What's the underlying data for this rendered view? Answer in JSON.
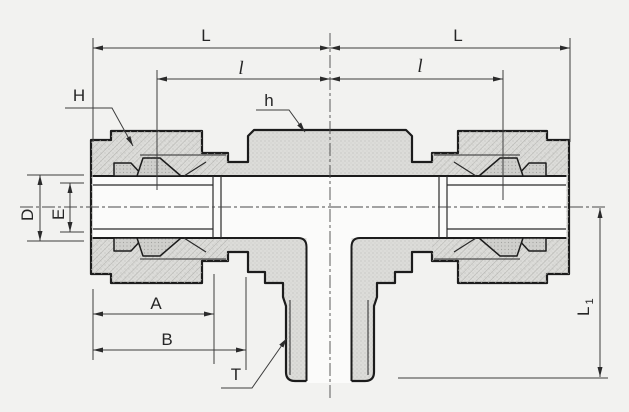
{
  "drawing": {
    "type": "technical-cross-section",
    "subject": "male-branch-tee-tube-fitting",
    "colors": {
      "background": "#f2f2f0",
      "outline": "#1c1c1c",
      "dimension_line": "#3d3d3d",
      "metal_fill": "#dcdcd9",
      "metal_fill_dark": "#cfcfcc",
      "bore_fill": "#fbfbfa"
    },
    "labels": {
      "length_left": "L",
      "length_right": "L",
      "insertion_left": "l",
      "insertion_right": "l",
      "nut_hex": "H",
      "body_hex": "h",
      "tube_od": "D",
      "bore_id": "E",
      "dim_a": "A",
      "dim_b": "B",
      "thread": "T",
      "branch_length_main": "L",
      "branch_length_sub": "1"
    },
    "dimensions": [
      {
        "label": "L",
        "orientation": "horizontal",
        "side": "left-end-to-center"
      },
      {
        "label": "L",
        "orientation": "horizontal",
        "side": "center-to-right-end"
      },
      {
        "label": "l",
        "orientation": "horizontal",
        "side": "left-insert-to-center"
      },
      {
        "label": "l",
        "orientation": "horizontal",
        "side": "center-to-right-insert"
      },
      {
        "label": "H",
        "orientation": "leader",
        "target": "left-nut-hex"
      },
      {
        "label": "h",
        "orientation": "leader",
        "target": "body-hex"
      },
      {
        "label": "D",
        "orientation": "vertical",
        "target": "tube-outer-diameter"
      },
      {
        "label": "E",
        "orientation": "vertical",
        "target": "bore-diameter"
      },
      {
        "label": "A",
        "orientation": "horizontal",
        "target": "nut-length"
      },
      {
        "label": "B",
        "orientation": "horizontal",
        "target": "end-to-body-hex"
      },
      {
        "label": "T",
        "orientation": "leader",
        "target": "male-taper-thread"
      },
      {
        "label": "L1",
        "orientation": "vertical",
        "target": "center-to-branch-end"
      }
    ]
  }
}
